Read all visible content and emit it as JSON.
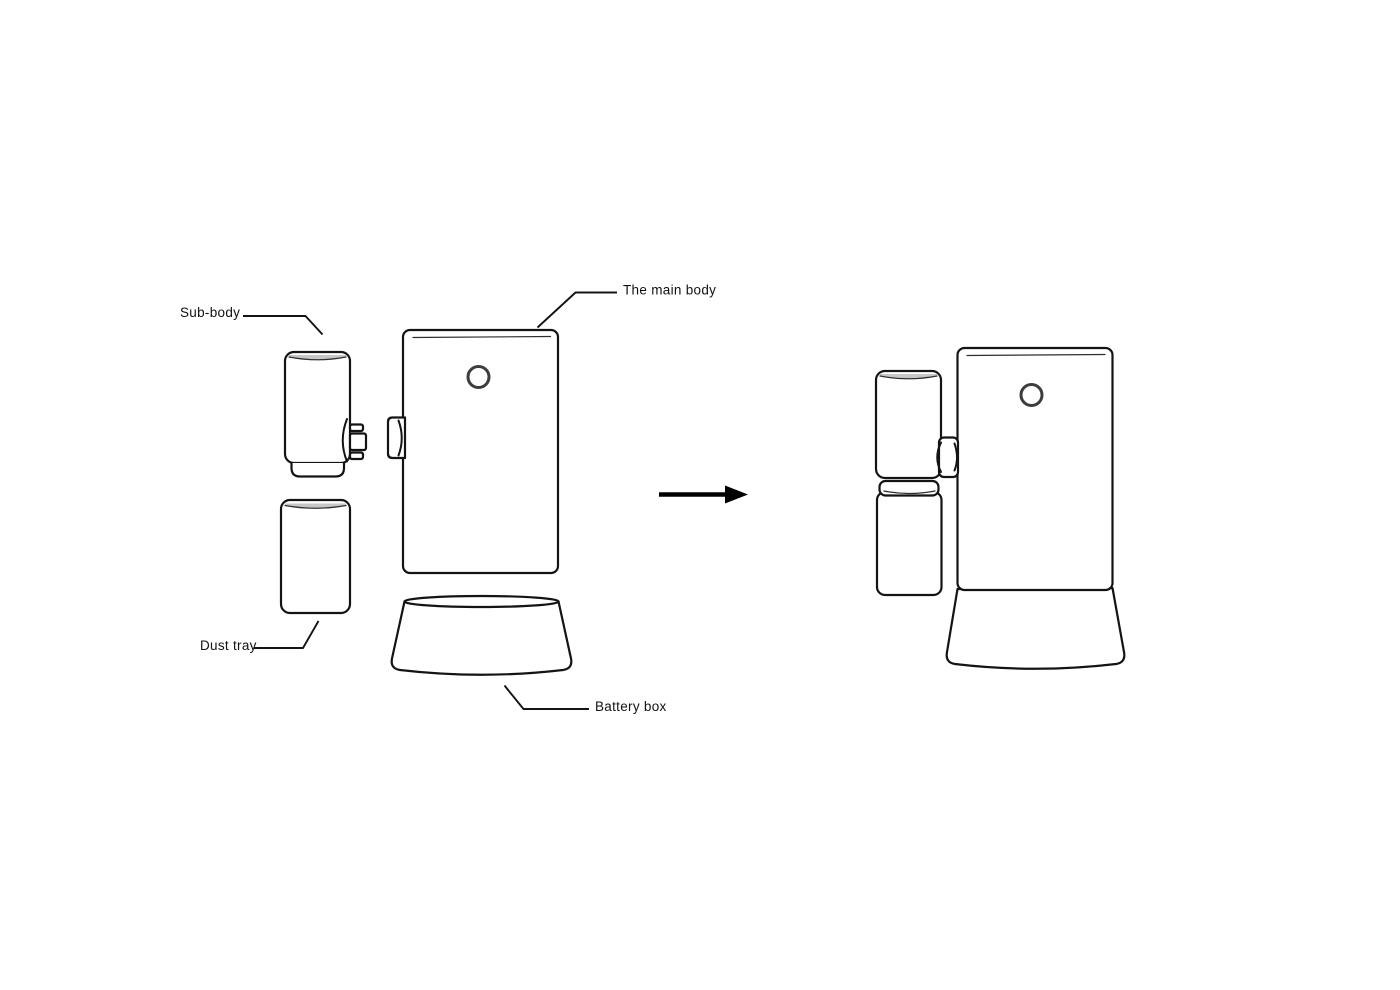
{
  "canvas": {
    "width_px": 1400,
    "height_px": 990,
    "background": "#ffffff"
  },
  "diagram": {
    "type": "product-exploded-assembly-diagram",
    "labels": {
      "sub_body": "Sub-body",
      "main_body": "The main body",
      "dust_tray": "Dust tray",
      "battery_box": "Battery box"
    },
    "arrow": {
      "direction": "right"
    },
    "views": {
      "left": "exploded parts",
      "right": "assembled unit"
    },
    "colors": {
      "outline": "#141414",
      "button_ring": "#3d3d3d",
      "rim_shade": "#c6c6c6",
      "label_text": "#111111",
      "background": "#ffffff"
    }
  }
}
